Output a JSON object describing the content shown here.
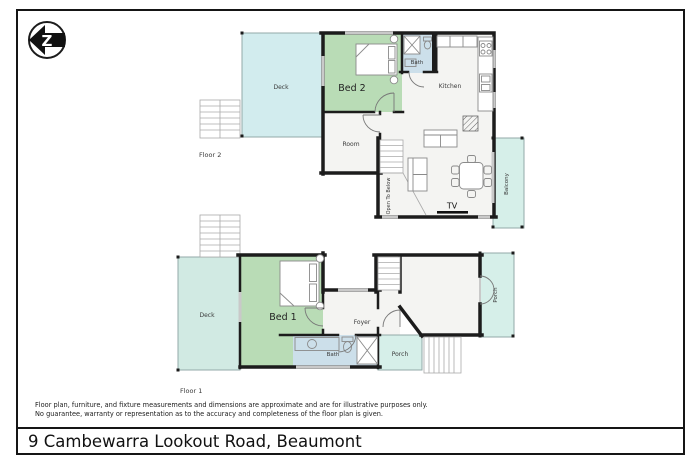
{
  "logo": {
    "letter": "Z"
  },
  "floor2": {
    "label": "Floor 2",
    "rooms": {
      "deck": "Deck",
      "bed2": "Bed 2",
      "bath": "Bath",
      "kitchen": "Kitchen",
      "room": "Room",
      "balcony": "Balcony"
    },
    "annotations": {
      "open_to_below": "Open To Below",
      "tv": "TV"
    }
  },
  "floor1": {
    "label": "Floor 1",
    "rooms": {
      "deck": "Deck",
      "bed1": "Bed 1",
      "foyer": "Foyer",
      "bath": "Bath",
      "porch": "Porch",
      "porch_right": "Porch"
    }
  },
  "footer": {
    "disclaimer_line1": "Floor plan, furniture, and fixture measurements and dimensions are approximate and are for illustrative purposes only.",
    "disclaimer_line2": "No guarantee, warranty or representation as to the accuracy and completeness of the floor plan is given.",
    "address": "9 Cambewarra Lookout Road, Beaumont"
  },
  "colors": {
    "wall": "#1c1c1c",
    "floor": "#f4f4f2",
    "bedroom": "#b9dcb6",
    "bathroom": "#ccdfea",
    "deck_upper": "#d2ecee",
    "deck_lower": "#d1eae3",
    "outdoor": "#d6efe9",
    "window": "#c9c9c9"
  }
}
